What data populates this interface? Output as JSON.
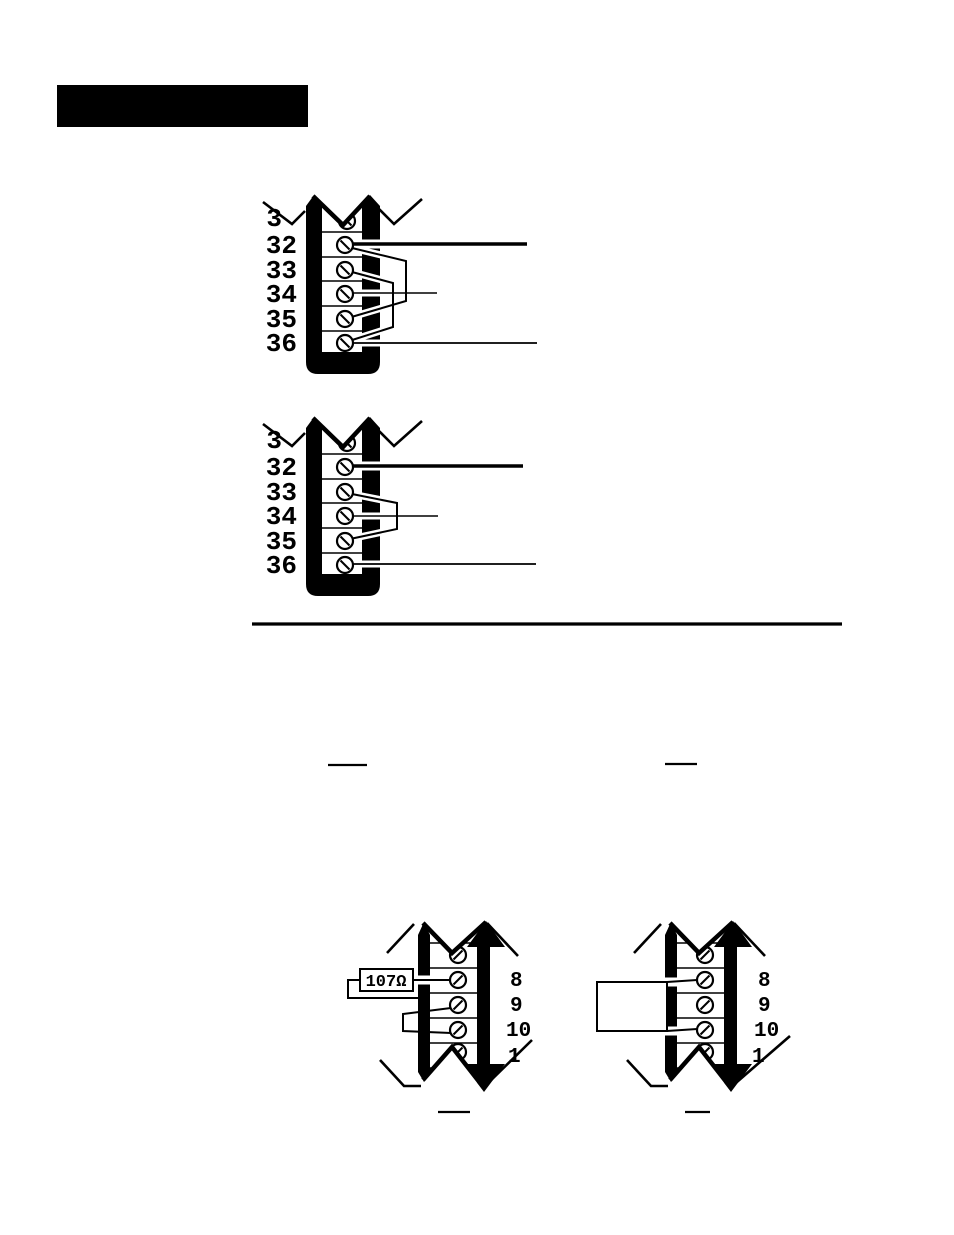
{
  "page": {
    "paper_color": "#ffffff",
    "ink_color": "#000000"
  },
  "diagram_upper": {
    "terminal_labels": [
      "3",
      "32",
      "33",
      "34",
      "35",
      "36"
    ],
    "wires_at_terminals": [
      "32",
      "34",
      "36"
    ],
    "jumper_pairs": [
      [
        "32",
        "35"
      ],
      [
        "33",
        "36"
      ]
    ]
  },
  "diagram_middle": {
    "terminal_labels": [
      "3",
      "32",
      "33",
      "34",
      "35",
      "36"
    ],
    "wires_at_terminals": [
      "32",
      "34",
      "36"
    ],
    "jumper_pairs": [
      [
        "33",
        "35"
      ]
    ]
  },
  "diagram_bottom_left": {
    "terminal_labels": [
      "8",
      "9",
      "10",
      "1"
    ],
    "resistor_label": "107Ω",
    "resistor_between_terminals": [
      "8",
      "9"
    ],
    "jumper_pair": [
      "9",
      "10"
    ]
  },
  "diagram_bottom_right": {
    "terminal_labels": [
      "8",
      "9",
      "10",
      "1"
    ],
    "device_box_between_terminals": [
      "8",
      "10"
    ]
  }
}
